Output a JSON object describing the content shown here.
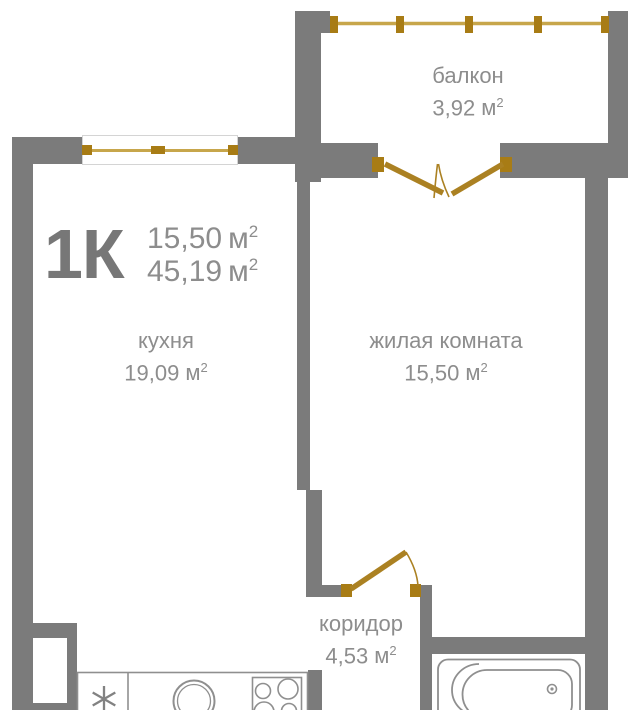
{
  "plan": {
    "title": "1К",
    "unit": {
      "symbol": "м",
      "exponent": "2"
    },
    "header": {
      "living_area": "15,50",
      "total_area": "45,19"
    },
    "rooms": [
      {
        "id": "kitchen",
        "name": "кухня",
        "area": "19,09"
      },
      {
        "id": "living",
        "name": "жилая комната",
        "area": "15,50"
      },
      {
        "id": "balcony",
        "name": "балкон",
        "area": "3,92"
      },
      {
        "id": "corridor",
        "name": "коридор",
        "area": "4,53"
      }
    ],
    "icons": {
      "kitchen-window-icon": "gold line with end caps in wall opening",
      "balcony-railing-icon": "gold rail line with square posts",
      "balcony-double-door-icon": "two gold leaves with center swing arcs",
      "corridor-door-icon": "gold leaf with swing arc",
      "fridge-icon": "six-ray asterisk",
      "sink-icon": "double circle",
      "stove-icon": "rect with four burner circles",
      "bathtub-icon": "rounded tub outline with drain",
      "vent-shaft": "white recess in wall"
    }
  },
  "colors": {
    "wall": "#7b7b7b",
    "background": "#ffffff",
    "text": "#8d8d8d",
    "title_text": "#777777",
    "gold": "#ab8122",
    "gold_dark": "#a87c15",
    "gold_light": "#c7a64b",
    "fixture_stroke": "#8f8f8f",
    "window_frame": "#d4d4d4"
  }
}
